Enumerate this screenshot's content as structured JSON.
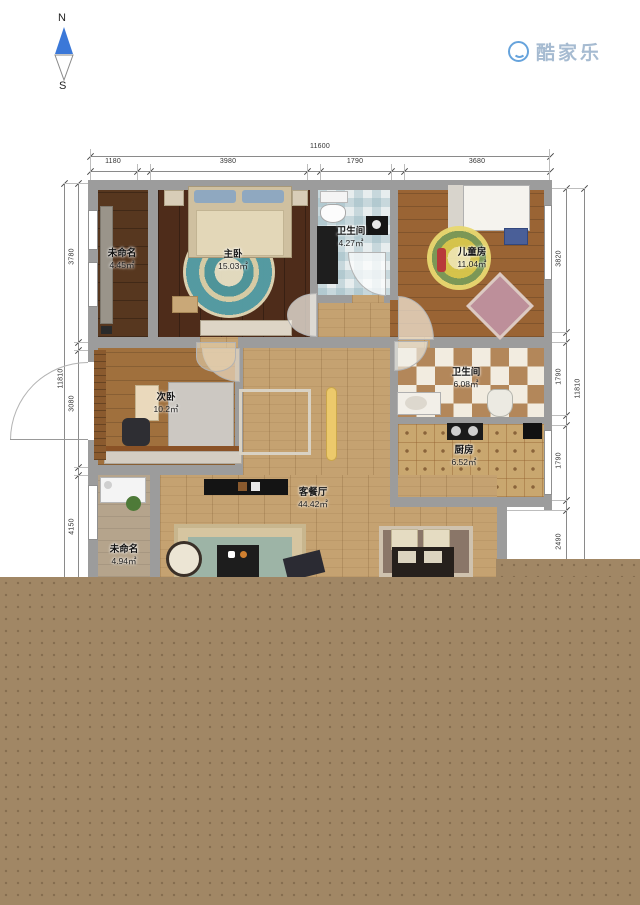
{
  "compass": {
    "north": "N",
    "south": "S"
  },
  "logo": {
    "icon": "kujiale-smile-icon",
    "text": "酷家乐",
    "icon_color": "#66a3dc",
    "text_color": "#a6bbd1"
  },
  "dimensions": {
    "top": {
      "total": "11600",
      "segments": [
        "1180",
        "3980",
        "1790",
        "3680"
      ]
    },
    "left": {
      "total": "11810",
      "segments": [
        "3780",
        "3080",
        "4150"
      ]
    },
    "right": {
      "total": "11810",
      "segments": [
        "3820",
        "1790",
        "1790",
        "2490"
      ]
    }
  },
  "rooms": [
    {
      "name": "未命名",
      "area": "4.45㎡"
    },
    {
      "name": "主卧",
      "area": "15.03㎡"
    },
    {
      "name": "卫生间",
      "area": "4.27㎡"
    },
    {
      "name": "儿童房",
      "area": "11.04㎡"
    },
    {
      "name": "次卧",
      "area": "10.2㎡"
    },
    {
      "name": "卫生间",
      "area": "6.08㎡"
    },
    {
      "name": "厨房",
      "area": "6.52㎡"
    },
    {
      "name": "客餐厅",
      "area": "44.42㎡"
    },
    {
      "name": "未命名",
      "area": "4.94㎡"
    }
  ],
  "colors": {
    "wall": "#9c9c9c",
    "master_floor": "#4e2c1a",
    "kids_floor": "#9a6434",
    "living_floor": "#c5a271",
    "bath_tile": "#e7edee",
    "checker_tile": "#b3875a",
    "overlay_brown": "#a18765",
    "compass_needle": "#3b78d8"
  }
}
